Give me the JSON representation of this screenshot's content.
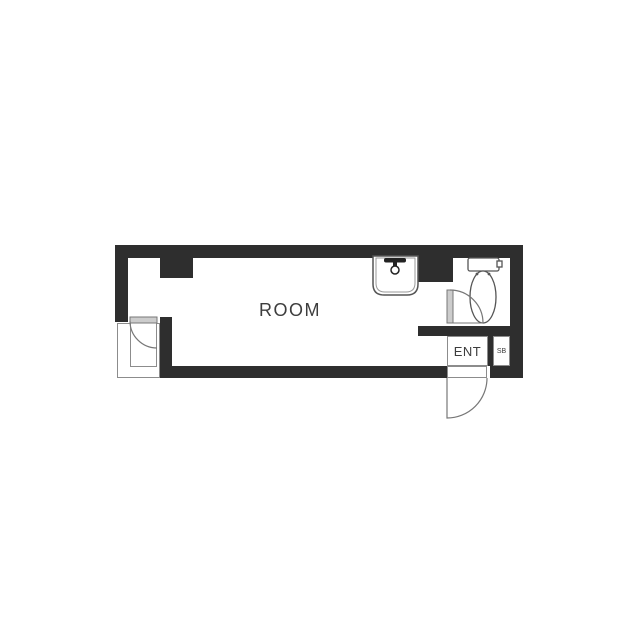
{
  "floorplan": {
    "title": "studio apartment floor plan",
    "room_label": "ROOM",
    "entrance_label": "ENT",
    "shoebox_label": "SB",
    "icons": [
      "toilet-icon",
      "sink-faucet-icon",
      "door-swing-icon"
    ],
    "colors": {
      "wall": "#2e2e2e",
      "thin_line": "#8c8c8c",
      "fixture_line": "#555555",
      "door_fill": "#cccccc",
      "text": "#3d3d3d",
      "background": "#ffffff"
    }
  }
}
